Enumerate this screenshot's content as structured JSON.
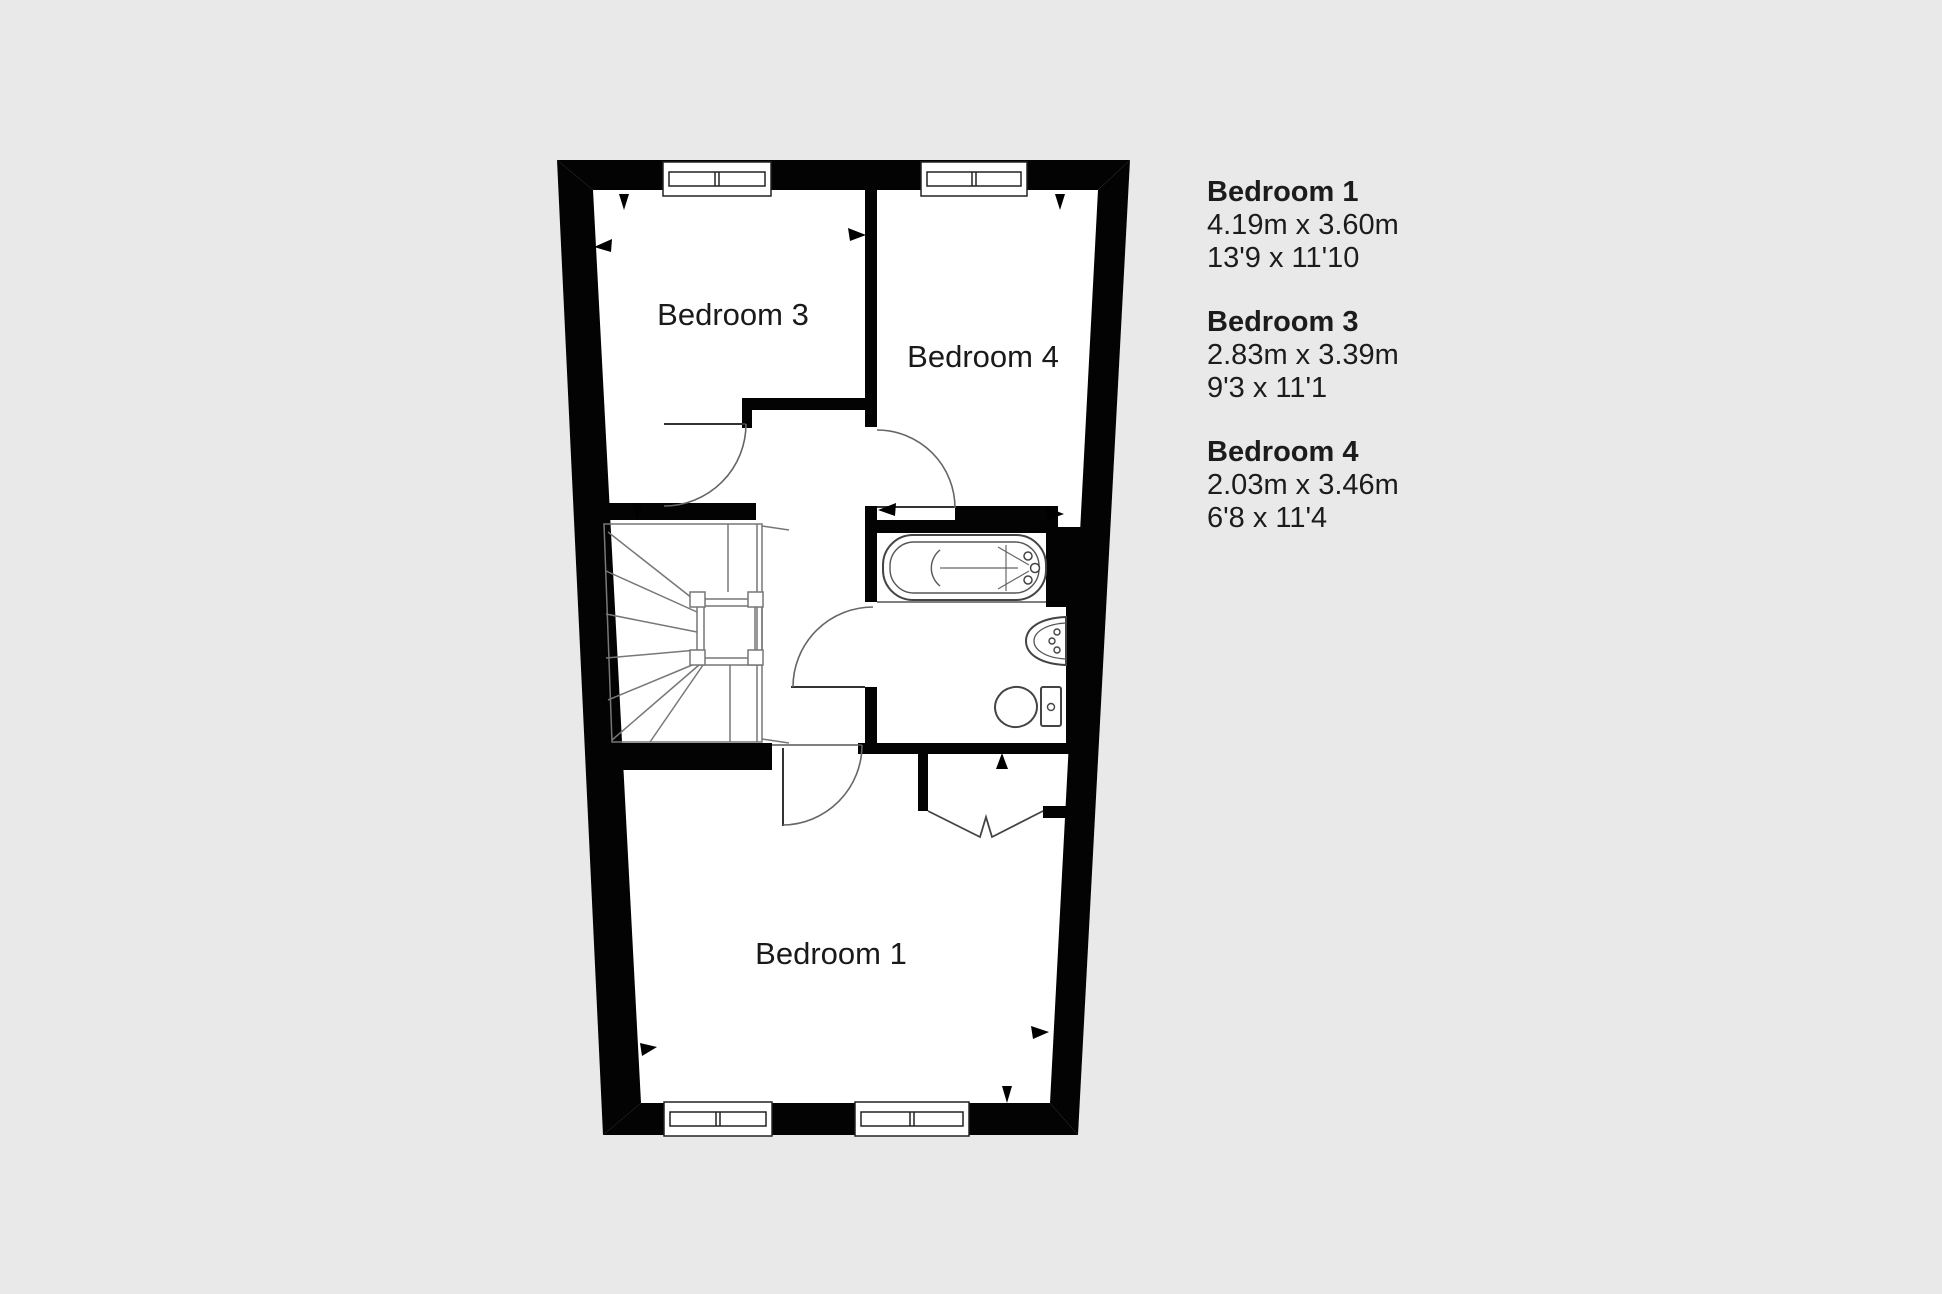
{
  "colors": {
    "background": "#e9e9e9",
    "wall": "#030303",
    "floor": "#ffffff",
    "text": "#1c1c1c"
  },
  "floor_plan": {
    "rooms": [
      {
        "id": "bedroom-3",
        "label": "Bedroom 3"
      },
      {
        "id": "bedroom-4",
        "label": "Bedroom 4"
      },
      {
        "id": "bedroom-1",
        "label": "Bedroom 1"
      }
    ],
    "fixtures": [
      "staircase",
      "bathtub",
      "sink",
      "toilet",
      "closet-bifold-doors",
      "windows",
      "door-swings"
    ]
  },
  "legend": {
    "entries": [
      {
        "name": "Bedroom 1",
        "metric": "4.19m x 3.60m",
        "imperial": "13'9 x 11'10"
      },
      {
        "name": "Bedroom 3",
        "metric": "2.83m x 3.39m",
        "imperial": "9'3 x 11'1"
      },
      {
        "name": "Bedroom 4",
        "metric": "2.03m x 3.46m",
        "imperial": "6'8 x 11'4"
      }
    ]
  }
}
